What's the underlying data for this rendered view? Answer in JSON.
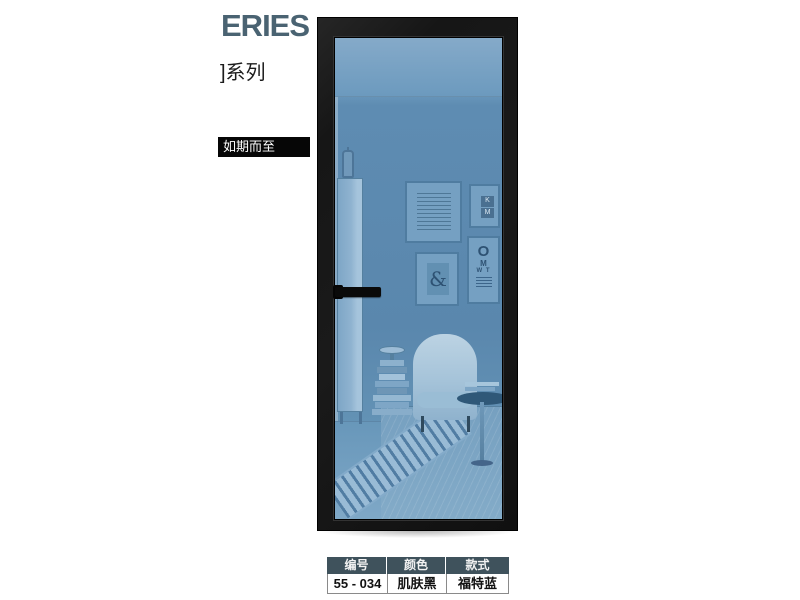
{
  "header": {
    "series_title": "ERIES",
    "series_subtitle": "]系列",
    "arrival_badge": "如期而至",
    "title_color": "#4a6372"
  },
  "door": {
    "description": "black aluminum framed door with blue tinted glass",
    "frame_color": "#171717",
    "glass_color": "#5e8cb2",
    "handle_color": "#0a0a0a"
  },
  "glass_scene": {
    "ampersand_print": "&",
    "eye_chart": {
      "row0": "O",
      "row1": "M",
      "row2": "W T"
    },
    "letter_tile": {
      "top": "K",
      "bottom": "M"
    }
  },
  "spec_table": {
    "header_bg": "#3f525c",
    "columns": [
      {
        "label": "编号",
        "value": "55 - 034"
      },
      {
        "label": "颜色",
        "value": "肌肤黑"
      },
      {
        "label": "款式",
        "value": "福特蓝"
      }
    ]
  }
}
